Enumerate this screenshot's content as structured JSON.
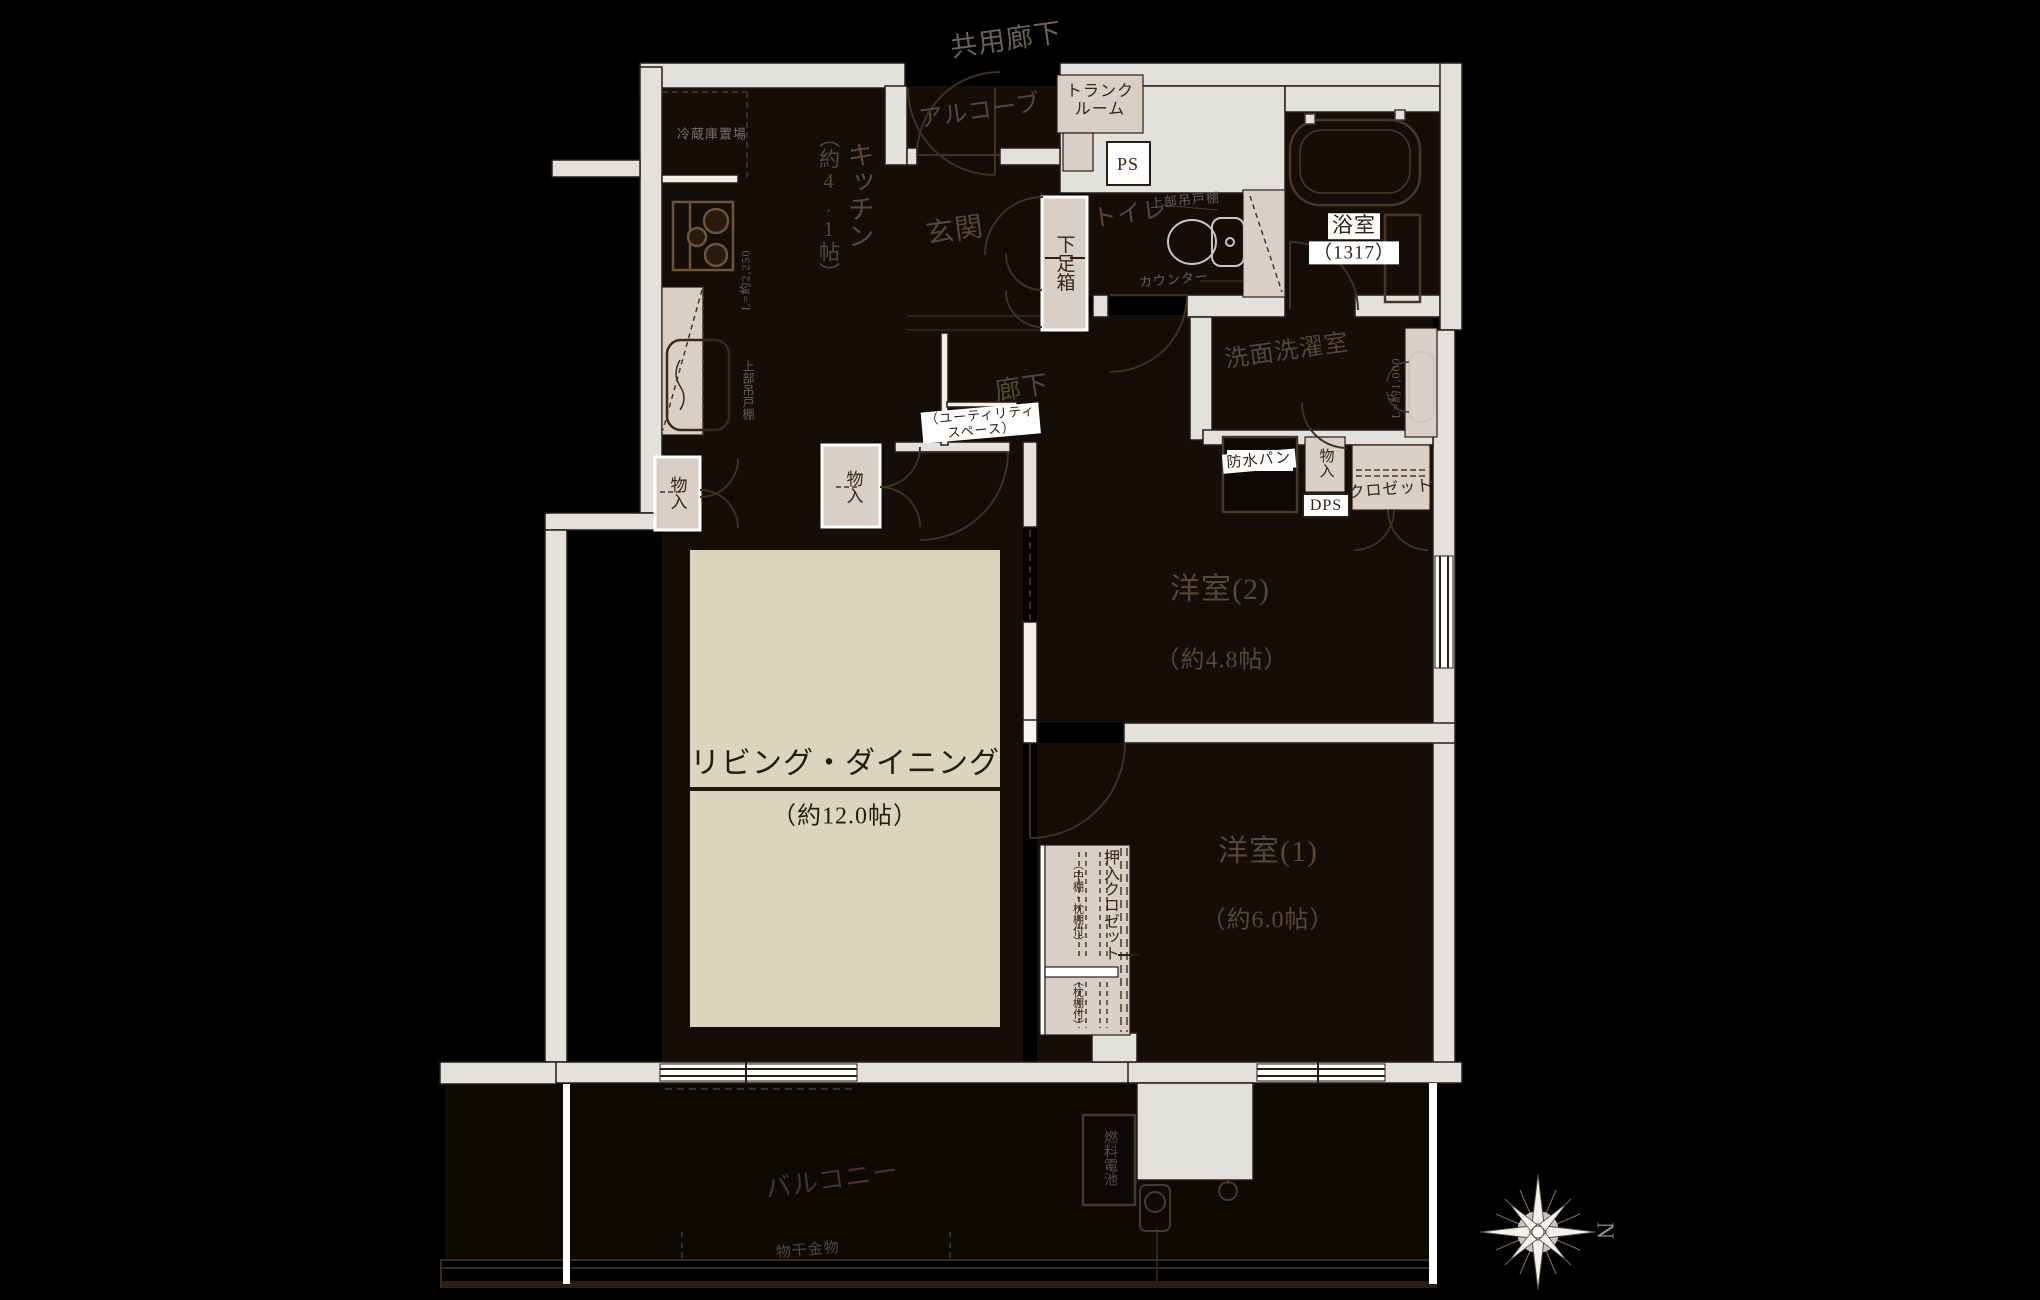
{
  "plan_type": "apartment-floorplan",
  "exterior": {
    "shared_corridor": "共用廊下",
    "alcove": "アルコーブ",
    "balcony": "バルコニー",
    "laundry_hardware": "物干金物",
    "fuel_cell": "燃料電池"
  },
  "rooms": {
    "kitchen": {
      "name": "キッチン",
      "size": "（約4.1帖）"
    },
    "entrance": {
      "name": "玄関"
    },
    "toilet": {
      "name": "トイレ"
    },
    "bathroom": {
      "name": "浴室",
      "size": "（1317）"
    },
    "washroom": {
      "name": "洗面洗濯室"
    },
    "corridor": {
      "name": "廊下"
    },
    "western2": {
      "name": "洋室(2)",
      "size": "（約4.8帖）"
    },
    "western1": {
      "name": "洋室(1)",
      "size": "（約6.0帖）"
    },
    "living": {
      "name": "リビング・ダイニング",
      "size": "（約12.0帖）"
    }
  },
  "features": {
    "refrigerator_space": "冷蔵庫置場",
    "trunk_room": "トランク\nルーム",
    "ps": "PS",
    "dps": "DPS",
    "shoe_box": "下足箱",
    "storage": "物入",
    "upper_cabinet": "上部吊戸棚",
    "counter": "カウンター",
    "kitchen_counter_length": "L=約2,250",
    "vanity_counter_length": "L=約1,000",
    "waterproof_pan": "防水パン",
    "closet": "クロゼット",
    "futon_closet": "押入クロゼット",
    "futon_closet_note": "（中棚・枕棚付）",
    "pillow_shelf_note": "（枕棚付）",
    "utility_space": "（ユーティリティ\nスペース）"
  },
  "compass": {
    "north": "N"
  },
  "colors": {
    "background": "#000000",
    "wall_gray": "#e3e1de",
    "room_dark": "#140d08",
    "living_floor_beige": "#ddd4bd",
    "furniture_beige": "#d9cfc7",
    "outline_brown": "#42301f",
    "label_chip_white": "#ffffff"
  }
}
